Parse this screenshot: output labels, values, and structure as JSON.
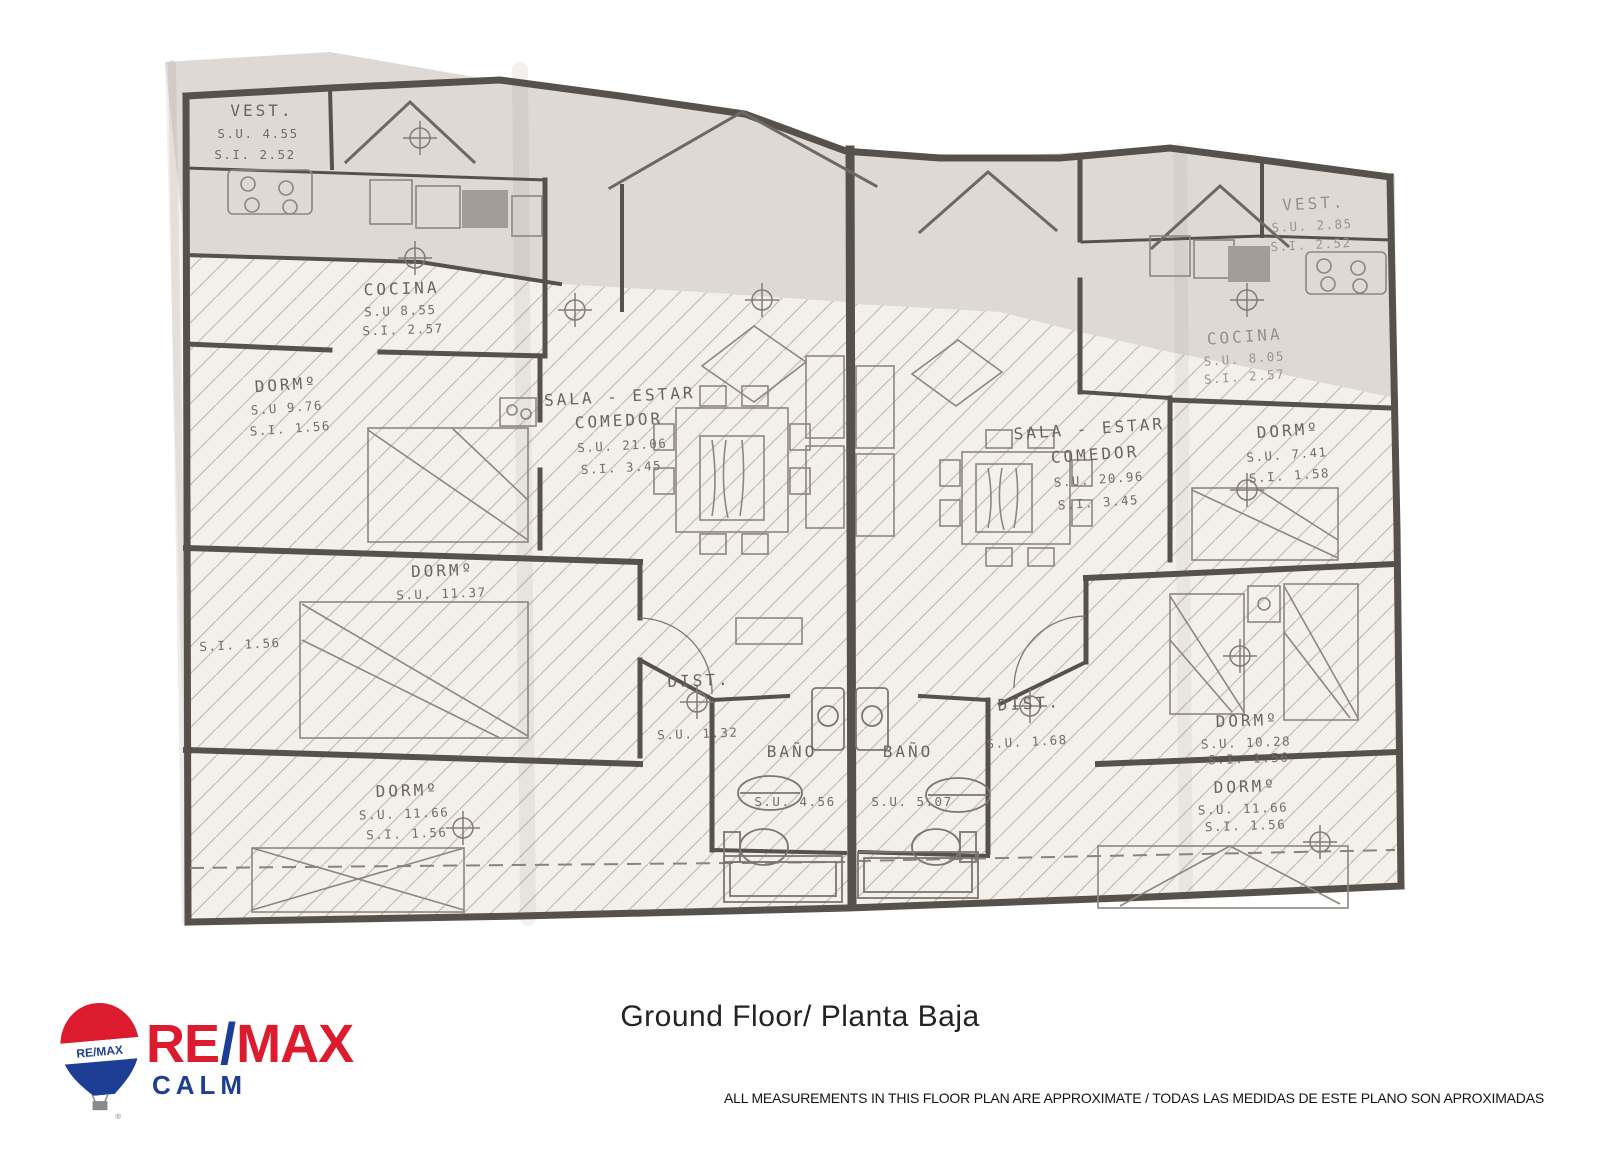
{
  "footer": {
    "title": "Ground Floor/ Planta Baja",
    "disclaimer": "ALL MEASUREMENTS IN THIS FLOOR PLAN ARE APPROXIMATE / TODAS LAS MEDIDAS DE ESTE PLANO SON APROXIMADAS",
    "logo": {
      "re": "RE",
      "slash": "/",
      "max": "MAX",
      "office": "CALM",
      "balloon_text": "RE/MAX",
      "registered": "®",
      "colors": {
        "red": "#dc1c2e",
        "blue": "#1d3e94"
      }
    }
  },
  "plan": {
    "left_unit": {
      "vest": {
        "name": "VEST.",
        "su": "S.U. 4.55",
        "si": "S.I. 2.52"
      },
      "cocina": {
        "name": "COCINA",
        "su": "S.U 8.55",
        "si": "S.I. 2.57"
      },
      "dorm1": {
        "name": "DORMº",
        "su": "S.U 9.76",
        "si": "S.I. 1.56"
      },
      "sala": {
        "name1": "SALA - ESTAR",
        "name2": "COMEDOR",
        "su": "S.U. 21.06",
        "si": "S.I. 3.45"
      },
      "dorm2": {
        "name": "DORMº",
        "su": "S.U. 11.37",
        "si": "S.I. 1.56"
      },
      "dist": {
        "name": "DIST.",
        "su": "S.U. 1.32"
      },
      "bano": {
        "name": "BAÑO",
        "su": "S.U. 4.56"
      },
      "dorm3": {
        "name": "DORMº",
        "su": "S.U. 11.66",
        "si": "S.I. 1.56"
      }
    },
    "right_unit": {
      "vest": {
        "name": "VEST.",
        "su": "S.U. 2.85",
        "si": "S.I. 2.52"
      },
      "cocina": {
        "name": "COCINA",
        "su": "S.U. 8.05",
        "si": "S.I. 2.57"
      },
      "sala": {
        "name1": "SALA - ESTAR",
        "name2": "COMEDOR",
        "su": "S.U. 20.96",
        "si": "S.I. 3.45"
      },
      "dorm1": {
        "name": "DORMº",
        "su": "S.U. 7.41",
        "si": "S.I. 1.58"
      },
      "dist": {
        "name": "DIST.",
        "su": "S.U. 1.68"
      },
      "bano": {
        "name": "BAÑO",
        "su": "S.U. 5.07"
      },
      "dorm2": {
        "name": "DORMº",
        "su": "S.U. 10.28",
        "si": "S.I. 1.56"
      },
      "dorm3": {
        "name": "DORMº",
        "su": "S.U. 11.66",
        "si": "S.I. 1.56"
      }
    }
  }
}
